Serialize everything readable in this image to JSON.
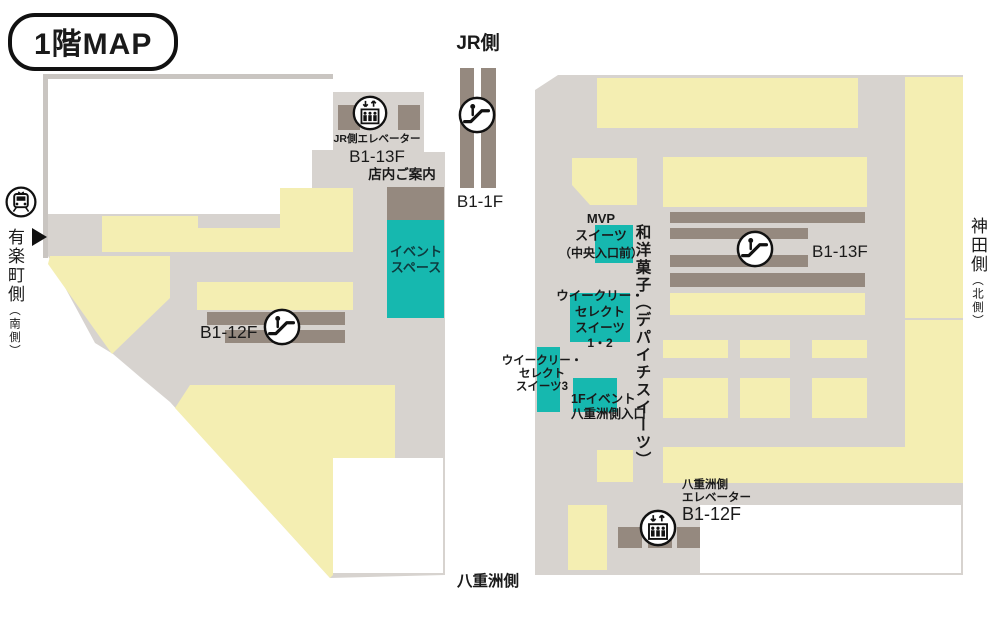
{
  "title": "1階MAP",
  "outside": {
    "jr_side": "JR側",
    "jr_strip_floors": "B1-1F",
    "yurakucho_side": "有楽町側",
    "yurakucho_sub": "（南側）",
    "kanda_side": "神田側",
    "kanda_sub": "（北側）",
    "yaesu_side": "八重洲側"
  },
  "left_building": {
    "jr_elevator_label": "JR側エレベーター",
    "jr_elevator_floors": "B1-13F",
    "store_guide": "店内ご案内",
    "event_space_lines": [
      "イベント",
      "スペース"
    ],
    "escalator_floors": "B1-12F"
  },
  "right_building": {
    "escalator_floors": "B1-13F",
    "mvp_lines": [
      "MVP",
      "スイーツ",
      "（中央入口前）"
    ],
    "confectionery_vertical": "和洋菓子（デパイチスイーツ）",
    "weekly_select_12_lines": [
      "ウイークリー・",
      "セレクト",
      "スイーツ",
      "1・2"
    ],
    "weekly_select_3_lines": [
      "ウイークリー・",
      "セレクト",
      "スイーツ3"
    ],
    "event_entrance_lines": [
      "1Fイベント",
      "八重洲側入口"
    ],
    "yaesu_elevator_lines": [
      "八重洲側",
      "エレベーター"
    ],
    "yaesu_elevator_floors": "B1-12F"
  },
  "colors": {
    "floor": "#d7d3cf",
    "shop_yellow": "#f4eeb2",
    "facility_brown": "#95897f",
    "highlight_teal": "#16b8af",
    "highlight_text": "#0e3a3e",
    "text": "#1a1a1a"
  }
}
